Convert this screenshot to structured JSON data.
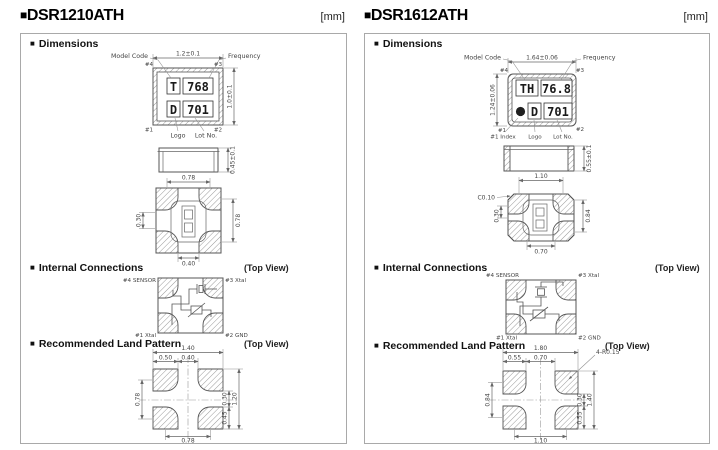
{
  "meta": {
    "unit_label": "[mm]",
    "marker": "■",
    "top_view_note": "(Top View)"
  },
  "sections": {
    "dimensions": "Dimensions",
    "internal": "Internal Connections",
    "land": "Recommended Land Pattern"
  },
  "colors": {
    "ink": "#333333",
    "drawing_line": "#555555",
    "hatch": "#999999",
    "box_border": "#a9a9a9",
    "background": "#ffffff"
  },
  "panels": [
    {
      "title": "DSR1210ATH",
      "top_view": {
        "model_code_label": "Model Code",
        "frequency_label": "Frequency",
        "logo_label": "Logo",
        "lot_label": "Lot No.",
        "width_dim": "1.2±0.1",
        "height_dim": "1.0±0.1",
        "pin_tl": "#4",
        "pin_tr": "#3",
        "pin_bl": "#1",
        "pin_br": "#2",
        "marking_model": "T",
        "marking_freq": "768",
        "marking_logo": "D",
        "marking_lot": "701"
      },
      "side_view": {
        "height_dim": "0.45±0.1"
      },
      "bottom_view": {
        "dim_top": "0.78",
        "dim_left": "0.30",
        "dim_right": "0.78",
        "dim_bottom": "0.40"
      },
      "internal": {
        "pin_tl": "#4 SENSOR",
        "pin_tr": "#3 Xtal",
        "pin_bl": "#1 Xtal",
        "pin_br": "#2 GND"
      },
      "land": {
        "dim_total_w": "1.40",
        "dim_pad_w": "0.50",
        "dim_gap_w": "0.40",
        "dim_left": "0.78",
        "dim_gap_h": "0.30",
        "dim_pad_h": "0.45",
        "dim_total_h": "1.20",
        "dim_bottom": "0.78"
      }
    },
    {
      "title": "DSR1612ATH",
      "top_view": {
        "model_code_label": "Model Code",
        "frequency_label": "Frequency",
        "index_label": "#1 Index",
        "logo_label": "Logo",
        "lot_label": "Lot No.",
        "width_dim": "1.64±0.06",
        "height_dim": "1.24±0.06",
        "pin_tl": "#4",
        "pin_tr": "#3",
        "pin_bl": "#1",
        "pin_br": "#2",
        "marking_model": "TH",
        "marking_freq": "76.8",
        "marking_logo": "D",
        "marking_lot": "701"
      },
      "side_view": {
        "height_dim": "0.55±0.1"
      },
      "bottom_view": {
        "dim_top": "1.10",
        "chamfer": "C0.10",
        "dim_left": "0.30",
        "dim_right": "0.84",
        "dim_bottom": "0.70"
      },
      "internal": {
        "pin_tl": "#4 SENSOR",
        "pin_tr": "#3 Xtal",
        "pin_bl": "#1 Xtal",
        "pin_br": "#2 GND"
      },
      "land": {
        "dim_total_w": "1.80",
        "dim_pad_w": "0.55",
        "dim_gap_w": "0.70",
        "corner_r": "4-R0.15",
        "dim_left": "0.84",
        "dim_gap_h": "0.30",
        "dim_pad_h": "0.55",
        "dim_total_h": "1.40",
        "dim_bottom": "1.10"
      }
    }
  ]
}
